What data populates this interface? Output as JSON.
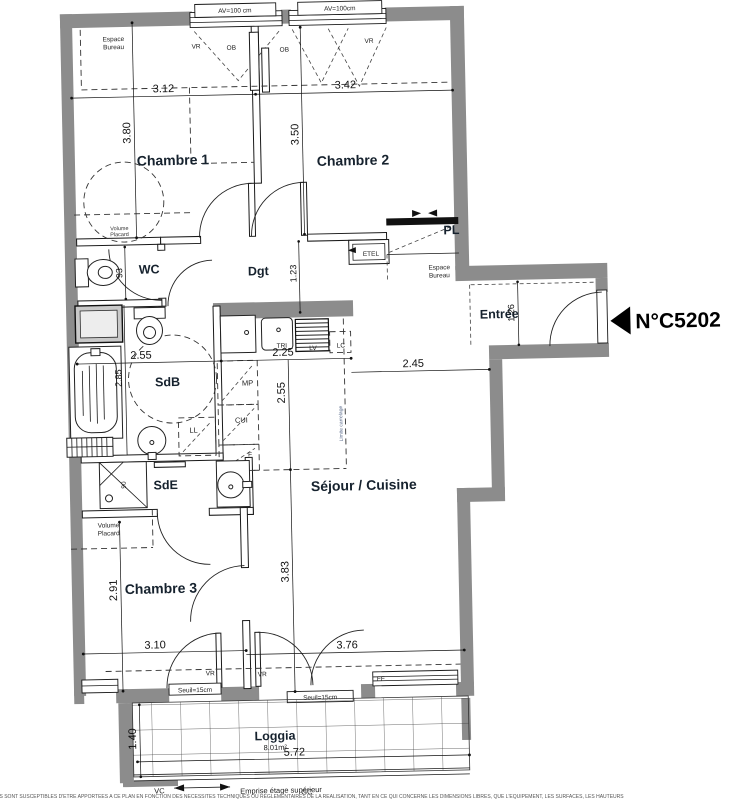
{
  "unit": {
    "number": "N°C5202"
  },
  "t": {
    "chambre1": "Chambre 1",
    "chambre2": "Chambre 2",
    "chambre3": "Chambre 3",
    "wc": "WC",
    "dgt": "Dgt",
    "sdb": "SdB",
    "sde": "SdE",
    "sejour": "Séjour / Cuisine",
    "entree": "Entrée",
    "loggia": "Loggia",
    "loggia_area": "8.01m²",
    "pl": "PL",
    "etel": "ETEL",
    "espace": "Espace",
    "bureau": "Bureau",
    "volume": "Volume",
    "placard": "Placard",
    "av1": "AV=100 cm",
    "av2": "AV=100cm",
    "vr": "VR",
    "ob": "OB",
    "ff": "FF",
    "seuil": "Seuil=15cm",
    "tri": "TRI",
    "lv": "LV",
    "lc": "LC",
    "ll": "LL",
    "mp": "MP",
    "cui": "CUI",
    "f": "F",
    "ninety": "90",
    "limite": "Limite carrelage",
    "vc": "VC",
    "emprise": "Emprise étage supérieur",
    "gc": "GC",
    "footer": "ONS SONT SUSCEPTIBLES D'ETRE APPORTEES A CE PLAN EN FONCTION DES NECESSITES TECHNIQUES OU REGLEMENTAIRES DE LA REALISATION, TANT EN CE QUI CONCERNE LES DIMENSIONS LIBRES, QUE L'EQUIPEMENT, LES SURFACES, LES HAUTEURS"
  },
  "d": {
    "v312": "3.12",
    "v342": "3.42",
    "v380": "3.80",
    "v350": "3.50",
    "v93": "93",
    "v123": "1.23",
    "v126": "1.26",
    "v255": "2.55",
    "v225": "2.25",
    "v245": "2.45",
    "v285": "2.85",
    "v255b": "2.55",
    "v383": "3.83",
    "v291": "2.91",
    "v310": "3.10",
    "v376": "3.76",
    "v140": "1.40",
    "v572": "5.72"
  },
  "colors": {
    "wall": "#8c8c8c",
    "label": "#16222e",
    "carrelage_note": "#5a6b8c"
  }
}
